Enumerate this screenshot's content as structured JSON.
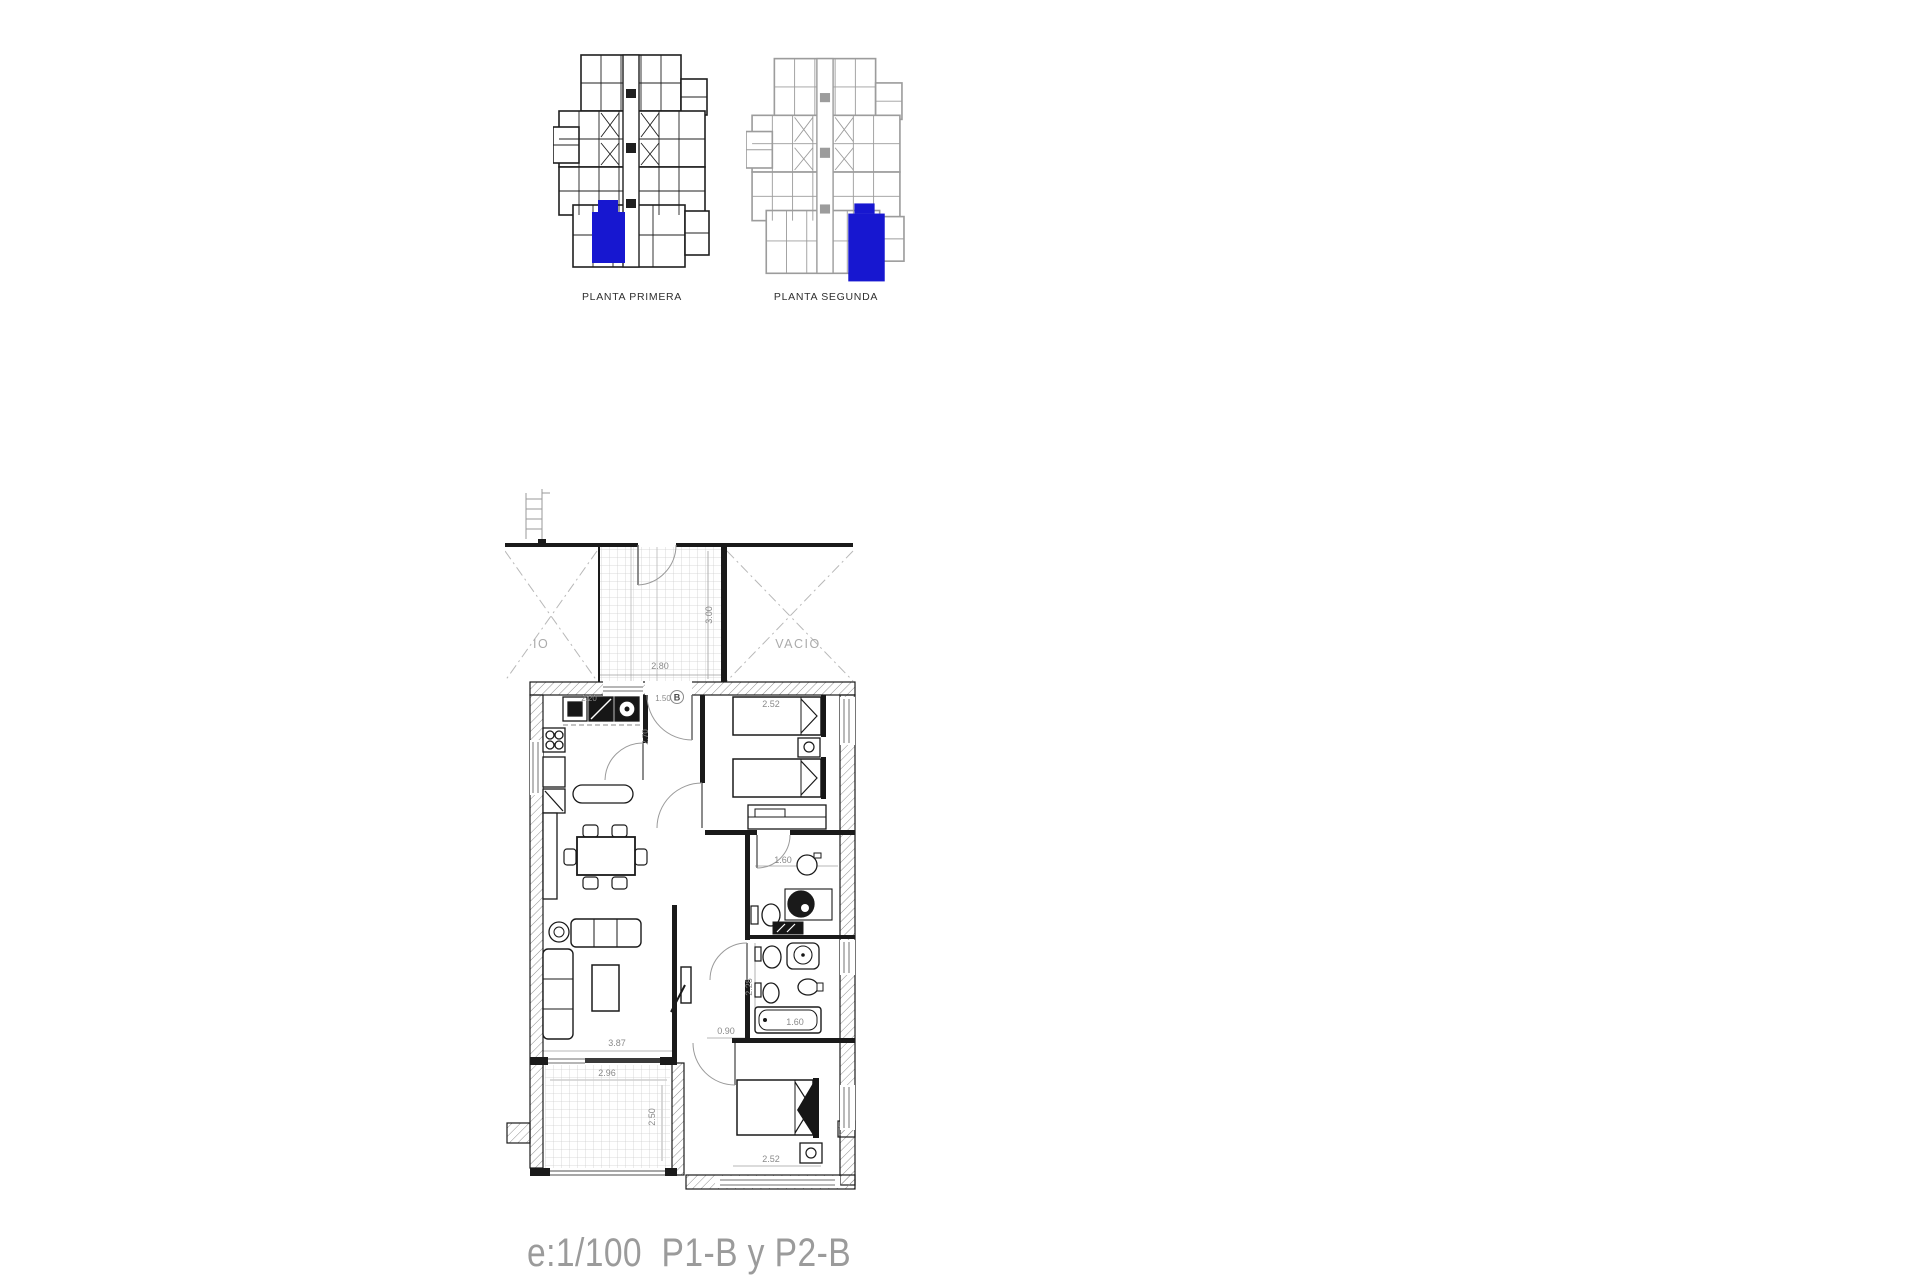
{
  "colors": {
    "highlight": "#1717d0",
    "plan_dark": "#1f1f1f",
    "plan_light": "#9c9c9c",
    "dim_text": "#8a8a8a",
    "footer_text": "#9b9b9b"
  },
  "key_plans": {
    "first": {
      "label": "PLANTA PRIMERA"
    },
    "second": {
      "label": "PLANTA SEGUNDA"
    }
  },
  "floor_plan": {
    "unit_marker": "B",
    "voids": {
      "left": "IO",
      "right": "VACIO"
    },
    "dimensions": {
      "terrace_top_width": "2.80",
      "terrace_top_depth": "3.00",
      "kitchen_width": "2.20",
      "entrance_width": "1.50",
      "hall_depth": "2.70",
      "bedroom1_width": "2.52",
      "bath1_width": "1.60",
      "bath2_depth": "2.28",
      "passage_width": "0.90",
      "bathtub_length": "1.60",
      "living_width": "3.87",
      "terrace_bottom_width": "2.96",
      "terrace_bottom_depth": "2.50",
      "bedroom2_width": "2.52"
    }
  },
  "footer": {
    "scale_label": "e:1/100  P1-B y P2-B"
  }
}
